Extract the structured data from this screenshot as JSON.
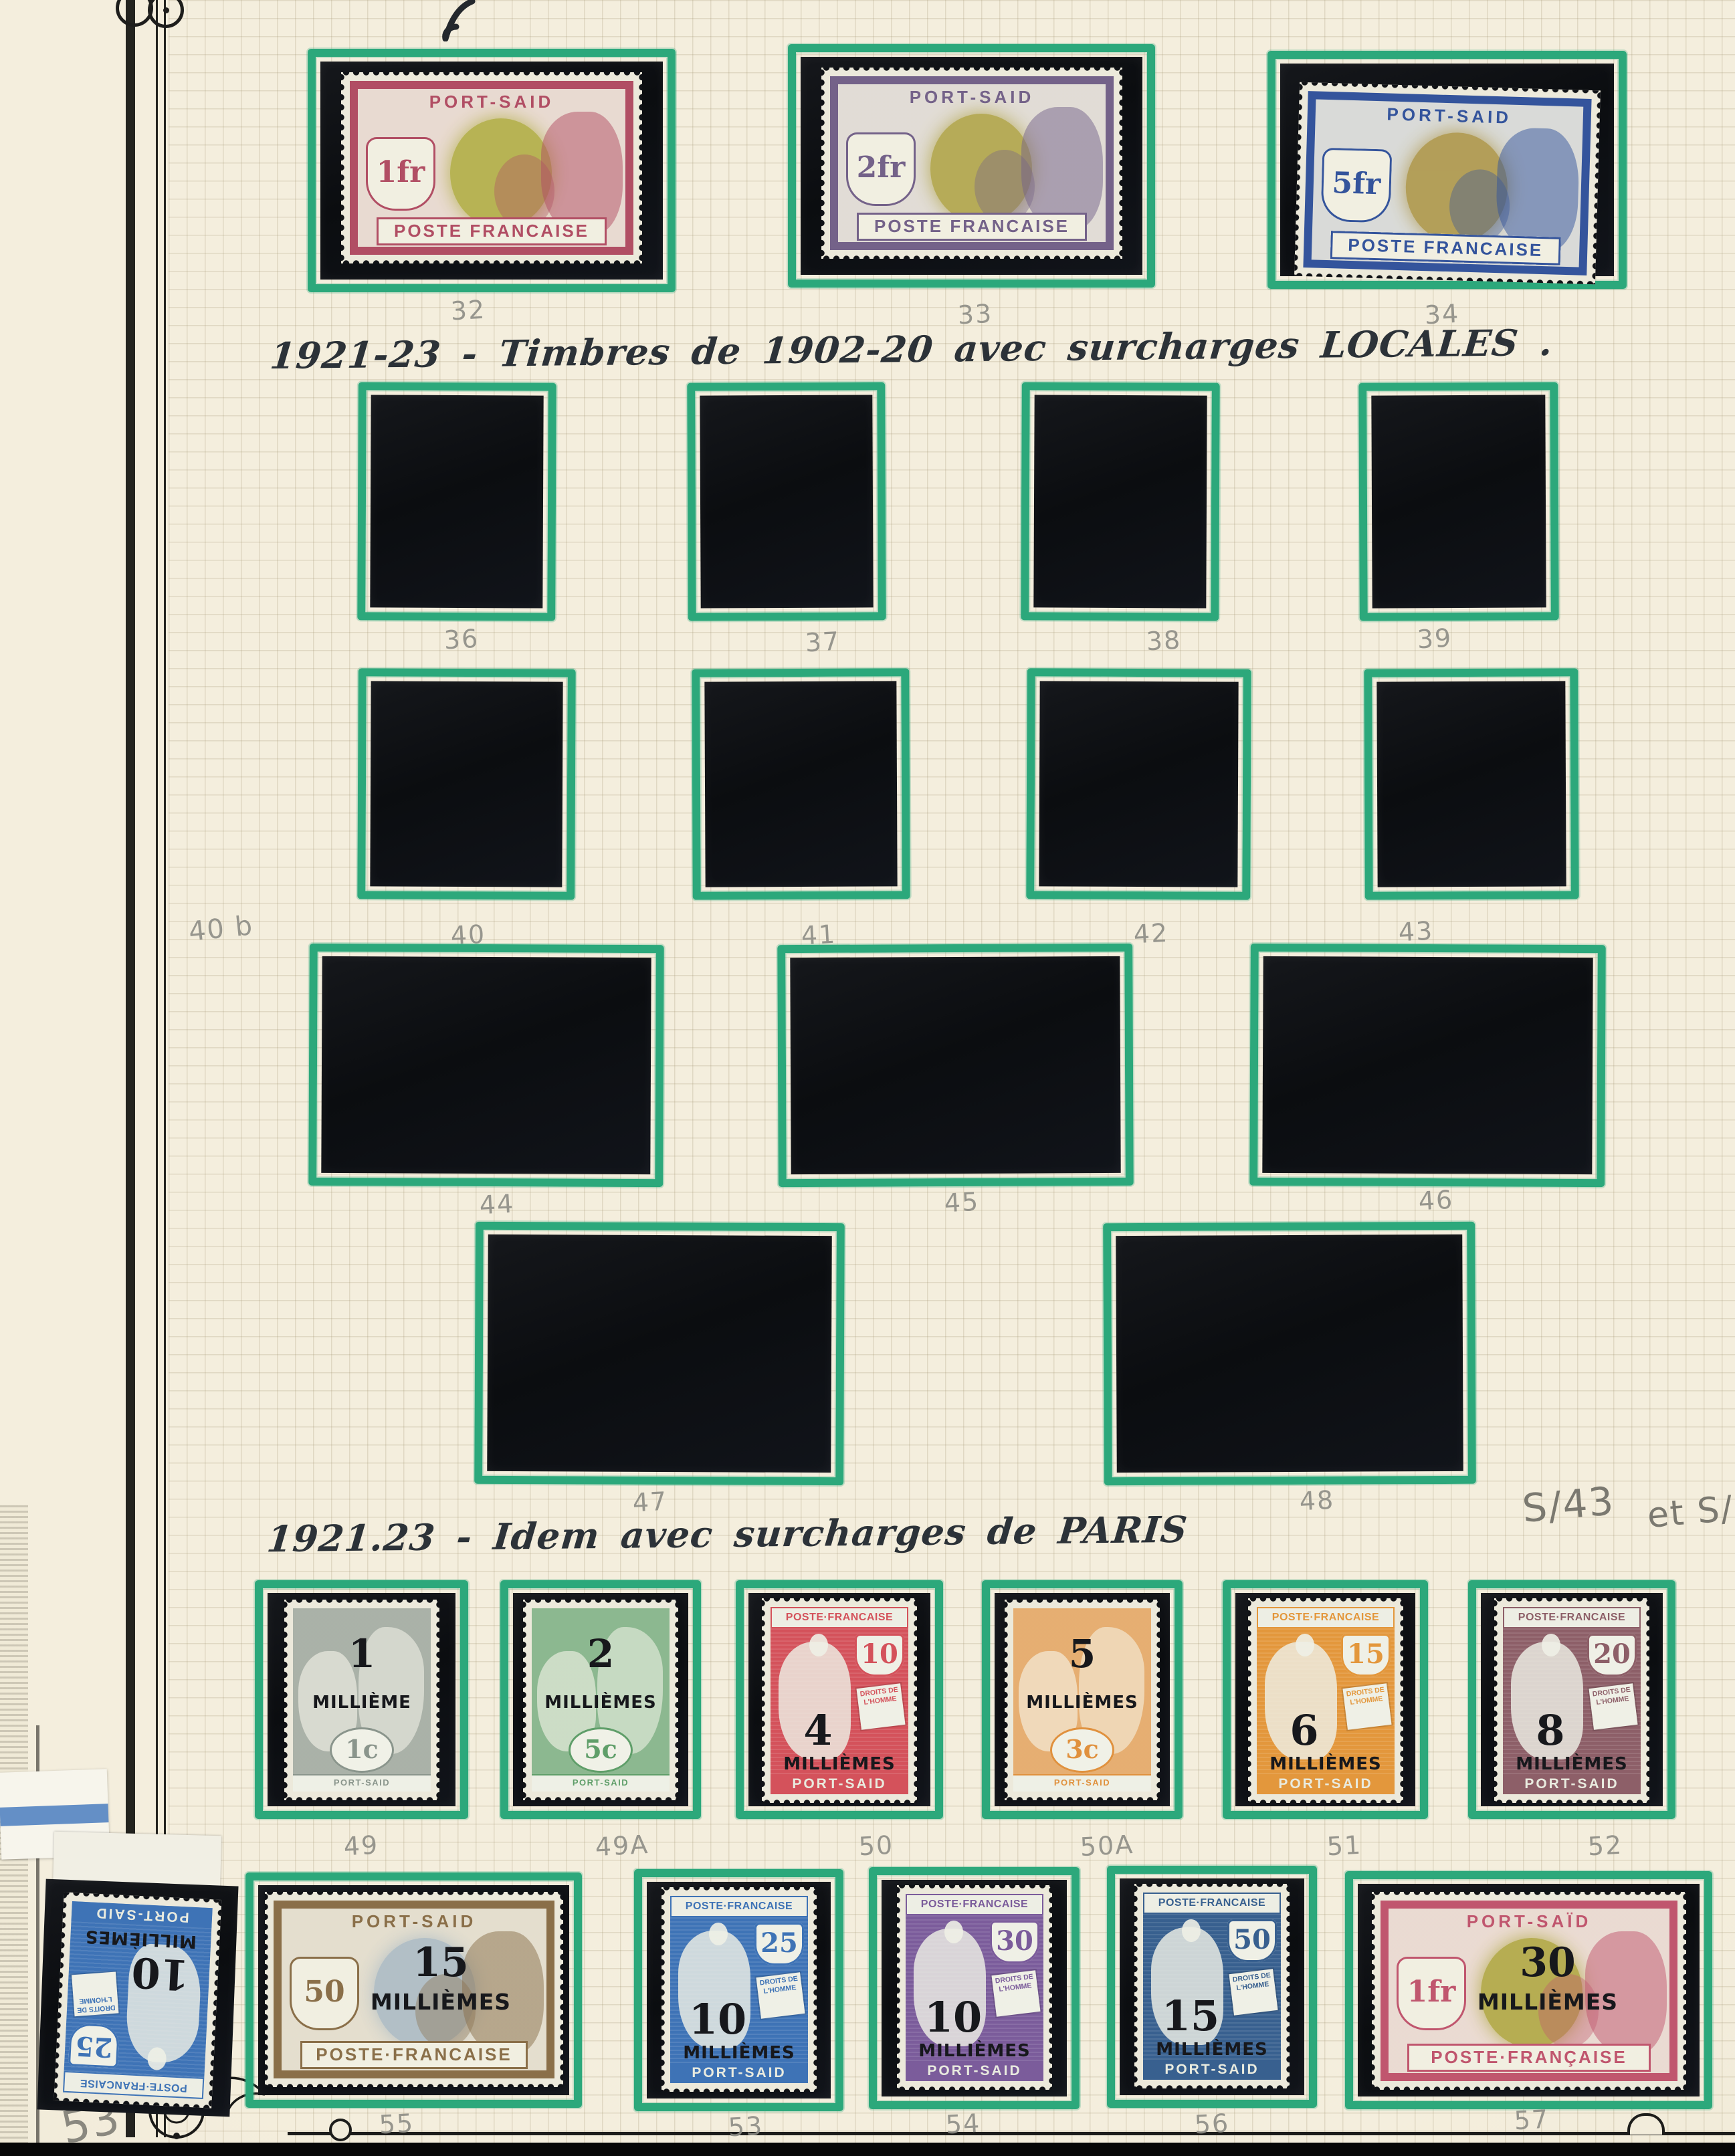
{
  "page": {
    "heading_locales": "1921-23 - Timbres de 1902-20 avec surcharges LOCALES .",
    "heading_paris": "1921.23 - Idem avec surcharges de PARIS",
    "margin_note": "40 b",
    "side_note_primary": "S/43",
    "side_note_secondary": "et S/4",
    "page_number_note": "53",
    "colors": {
      "paper": "#f2ecdb",
      "frame_green": "#2ca87b",
      "mount_black": "#0f1115",
      "pencil_gray": "#8e8d86",
      "ink_dark": "#2c3238"
    }
  },
  "top_stamps": [
    {
      "number": "32",
      "denomination": "1fr",
      "country": "PORT-SAID",
      "bottom_text": "POSTE FRANCAISE",
      "frame_color": "#b14e64",
      "center_color": "#b3b04a"
    },
    {
      "number": "33",
      "denomination": "2fr",
      "country": "PORT-SAID",
      "bottom_text": "POSTE FRANCAISE",
      "frame_color": "#746289",
      "center_color": "#b3a74e"
    },
    {
      "number": "34",
      "denomination": "5fr",
      "country": "PORT-SAID",
      "bottom_text": "POSTE FRANCAISE",
      "frame_color": "#34549c",
      "center_color": "#b09a4f"
    }
  ],
  "empty_mounts": {
    "rows": [
      {
        "numbers": [
          "36",
          "37",
          "38",
          "39"
        ]
      },
      {
        "numbers": [
          "40",
          "41",
          "42",
          "43"
        ]
      },
      {
        "numbers": [
          "44",
          "45",
          "46"
        ]
      },
      {
        "numbers": [
          "47",
          "48"
        ]
      }
    ]
  },
  "paris_row": [
    {
      "number": "49",
      "type": "blanc",
      "color": "#8a958c",
      "denomination": "1c",
      "surcharge_value": "1",
      "surcharge_word": "MILLIÈME",
      "country": "PORT-SAID"
    },
    {
      "number": "49A",
      "type": "blanc",
      "color": "#5f9e69",
      "denomination": "5c",
      "surcharge_value": "2",
      "surcharge_word": "MILLIÈMES",
      "country": "PORT-SAID"
    },
    {
      "number": "50",
      "type": "mouchon",
      "color": "#d4525b",
      "denomination": "10",
      "surcharge_value": "4",
      "surcharge_word": "MILLIÈMES",
      "country": "PORT-SAID",
      "header": "POSTE·FRANCAISE",
      "tablet": "DROITS DE L'HOMME"
    },
    {
      "number": "50A",
      "type": "blanc",
      "color": "#e0913e",
      "denomination": "3c",
      "surcharge_value": "5",
      "surcharge_word": "MILLIÈMES",
      "country": "PORT-SAID"
    },
    {
      "number": "51",
      "type": "mouchon",
      "color": "#e3973c",
      "denomination": "15",
      "surcharge_value": "6",
      "surcharge_word": "MILLIÈMES",
      "country": "PORT-SAID",
      "header": "POSTE·FRANCAISE",
      "tablet": "DROITS DE L'HOMME"
    },
    {
      "number": "52",
      "type": "mouchon",
      "color": "#8d5f68",
      "denomination": "20",
      "surcharge_value": "8",
      "surcharge_word": "MILLIÈMES",
      "country": "PORT-SAID",
      "header": "POSTE·FRANCAISE",
      "tablet": "DROITS DE L'HOMME"
    }
  ],
  "bottom_row": [
    {
      "number": "53",
      "type": "mouchon",
      "color": "#3e73b6",
      "denomination": "25",
      "surcharge_value": "10",
      "surcharge_word": "MILLIÈMES",
      "country": "PORT-SAID",
      "header": "POSTE·FRANCAISE",
      "tablet": "DROITS DE L'HOMME",
      "orientation": "inverted with sheet margin"
    },
    {
      "number": "55",
      "type": "merson",
      "frame_color": "#8a6f49",
      "center_color": "#aebdc6",
      "denomination": "50",
      "surcharge_value": "15",
      "surcharge_word": "MILLIÈMES",
      "country": "PORT-SAID",
      "bottom_text": "POSTE·FRANCAISE"
    },
    {
      "number": "53",
      "type": "mouchon",
      "color": "#3e73b6",
      "denomination": "25",
      "surcharge_value": "10",
      "surcharge_word": "MILLIÈMES",
      "country": "PORT-SAID",
      "header": "POSTE·FRANCAISE",
      "tablet": "DROITS DE L'HOMME"
    },
    {
      "number": "54",
      "type": "mouchon",
      "color": "#7b5c9b",
      "denomination": "30",
      "surcharge_value": "10",
      "surcharge_word": "MILLIÈMES",
      "country": "PORT-SAID",
      "header": "POSTE·FRANCAISE",
      "tablet": "DROITS DE L'HOMME"
    },
    {
      "number": "56",
      "type": "mouchon",
      "color": "#38608f",
      "denomination": "50",
      "surcharge_value": "15",
      "surcharge_word": "MILLIÈMES",
      "country": "PORT-SAID",
      "header": "POSTE·FRANCAISE",
      "tablet": "DROITS DE L'HOMME"
    },
    {
      "number": "57",
      "type": "merson",
      "frame_color": "#c0566e",
      "center_color": "#b2aa48",
      "denomination": "1fr",
      "surcharge_value": "30",
      "surcharge_word": "MILLIÈMES",
      "country": "PORT-SAÏD",
      "bottom_text": "POSTE·FRANÇAISE"
    }
  ]
}
